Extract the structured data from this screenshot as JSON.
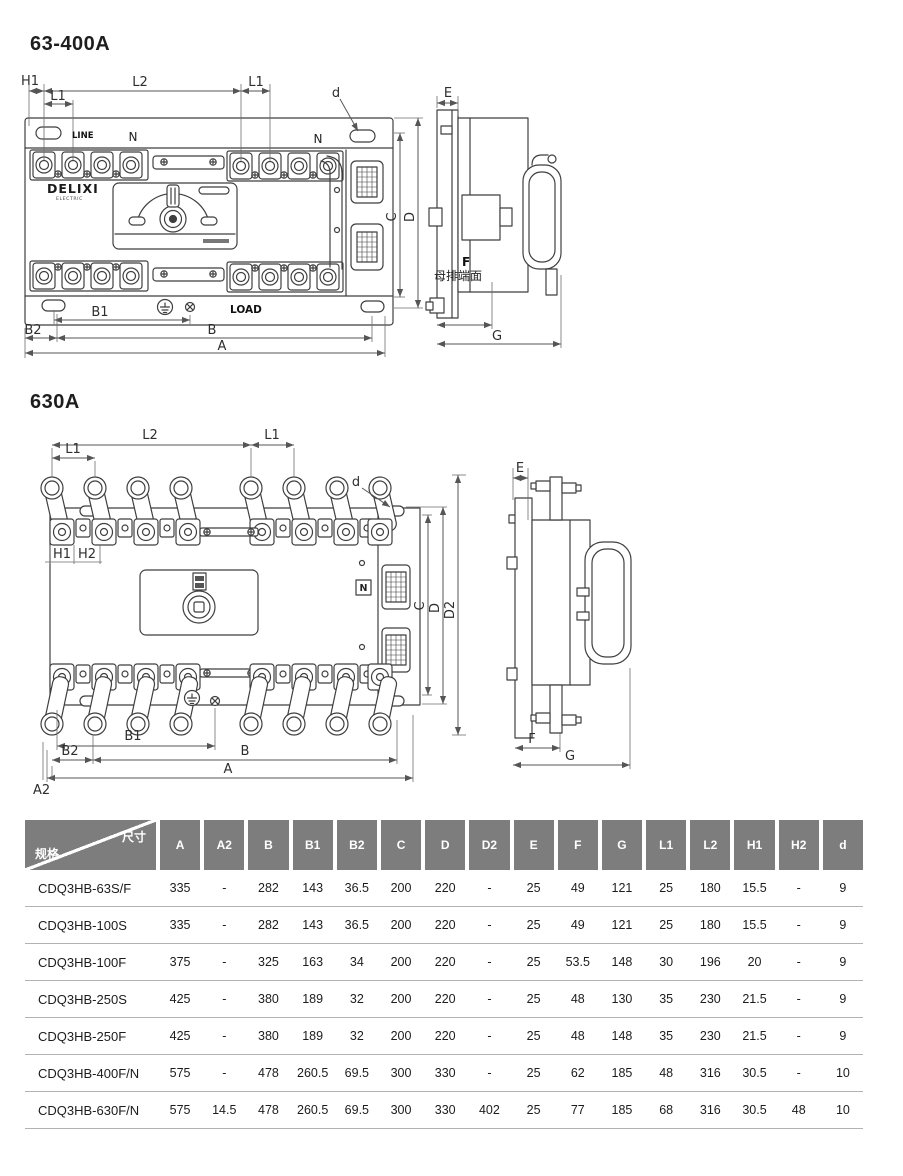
{
  "d1": {
    "title": "63-400A",
    "labels": {
      "h1": "H1",
      "l1_left": "L1",
      "l2": "L2",
      "l1_right": "L1",
      "d": "d",
      "line": "LINE",
      "n_left": "N",
      "n_right": "N",
      "load": "LOAD",
      "brand": "DELIXI",
      "brand_sub": "ELECTRIC",
      "b1": "B1",
      "b2": "B2",
      "b": "B",
      "a": "A",
      "c": "C",
      "dim_d": "D",
      "e": "E",
      "f": "F",
      "busbar_face": "母排端面",
      "g": "G"
    }
  },
  "d2": {
    "title": "630A",
    "labels": {
      "l1_left": "L1",
      "l2": "L2",
      "l1_right": "L1",
      "h1": "H1",
      "h2": "H2",
      "d": "d",
      "n": "N",
      "c": "C",
      "dim_d": "D",
      "d2": "D2",
      "b1": "B1",
      "b2": "B2",
      "b": "B",
      "a": "A",
      "a2": "A2",
      "e": "E",
      "f": "F",
      "g": "G"
    }
  },
  "table": {
    "corner_top": "尺寸",
    "corner_bottom": "规格",
    "header_bg": "#7d7d7d",
    "columns": [
      "A",
      "A2",
      "B",
      "B1",
      "B2",
      "C",
      "D",
      "D2",
      "E",
      "F",
      "G",
      "L1",
      "L2",
      "H1",
      "H2",
      "d"
    ],
    "rows": [
      {
        "model": "CDQ3HB-63S/F",
        "values": [
          "335",
          "-",
          "282",
          "143",
          "36.5",
          "200",
          "220",
          "-",
          "25",
          "49",
          "121",
          "25",
          "180",
          "15.5",
          "-",
          "9"
        ]
      },
      {
        "model": "CDQ3HB-100S",
        "values": [
          "335",
          "-",
          "282",
          "143",
          "36.5",
          "200",
          "220",
          "-",
          "25",
          "49",
          "121",
          "25",
          "180",
          "15.5",
          "-",
          "9"
        ]
      },
      {
        "model": "CDQ3HB-100F",
        "values": [
          "375",
          "-",
          "325",
          "163",
          "34",
          "200",
          "220",
          "-",
          "25",
          "53.5",
          "148",
          "30",
          "196",
          "20",
          "-",
          "9"
        ]
      },
      {
        "model": "CDQ3HB-250S",
        "values": [
          "425",
          "-",
          "380",
          "189",
          "32",
          "200",
          "220",
          "-",
          "25",
          "48",
          "130",
          "35",
          "230",
          "21.5",
          "-",
          "9"
        ]
      },
      {
        "model": "CDQ3HB-250F",
        "values": [
          "425",
          "-",
          "380",
          "189",
          "32",
          "200",
          "220",
          "-",
          "25",
          "48",
          "148",
          "35",
          "230",
          "21.5",
          "-",
          "9"
        ]
      },
      {
        "model": "CDQ3HB-400F/N",
        "values": [
          "575",
          "-",
          "478",
          "260.5",
          "69.5",
          "300",
          "330",
          "-",
          "25",
          "62",
          "185",
          "48",
          "316",
          "30.5",
          "-",
          "10"
        ]
      },
      {
        "model": "CDQ3HB-630F/N",
        "values": [
          "575",
          "14.5",
          "478",
          "260.5",
          "69.5",
          "300",
          "330",
          "402",
          "25",
          "77",
          "185",
          "68",
          "316",
          "30.5",
          "48",
          "10"
        ]
      }
    ]
  }
}
